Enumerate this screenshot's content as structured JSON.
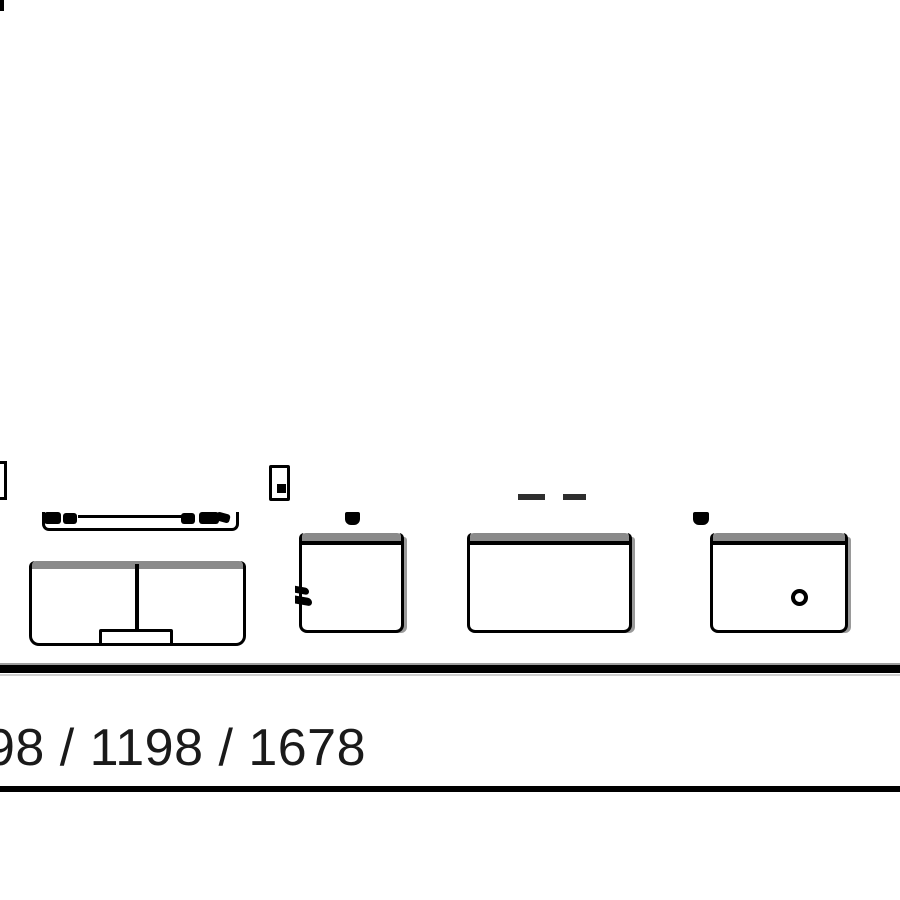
{
  "labels": {
    "dimensions": "98 / 1198 / 1678"
  },
  "colors": {
    "line": "#000000",
    "band": "#8a8a8a",
    "shadow": "#9a9a9a",
    "bg": "#ffffff",
    "text": "#1a1a1a"
  },
  "parts": [
    "sliding-panel-left",
    "sliding-panel-right",
    "door-rail",
    "rail-fixing-marks",
    "edge-stop-bracket",
    "center-stop-bracket",
    "roller-trolley",
    "rail-stop-knobs",
    "double-door-cabinet-with-foot",
    "door-front-with-latch",
    "drawer-front-plain",
    "door-front-with-round-knob",
    "base-line",
    "dimension-label",
    "bottom-rule"
  ]
}
